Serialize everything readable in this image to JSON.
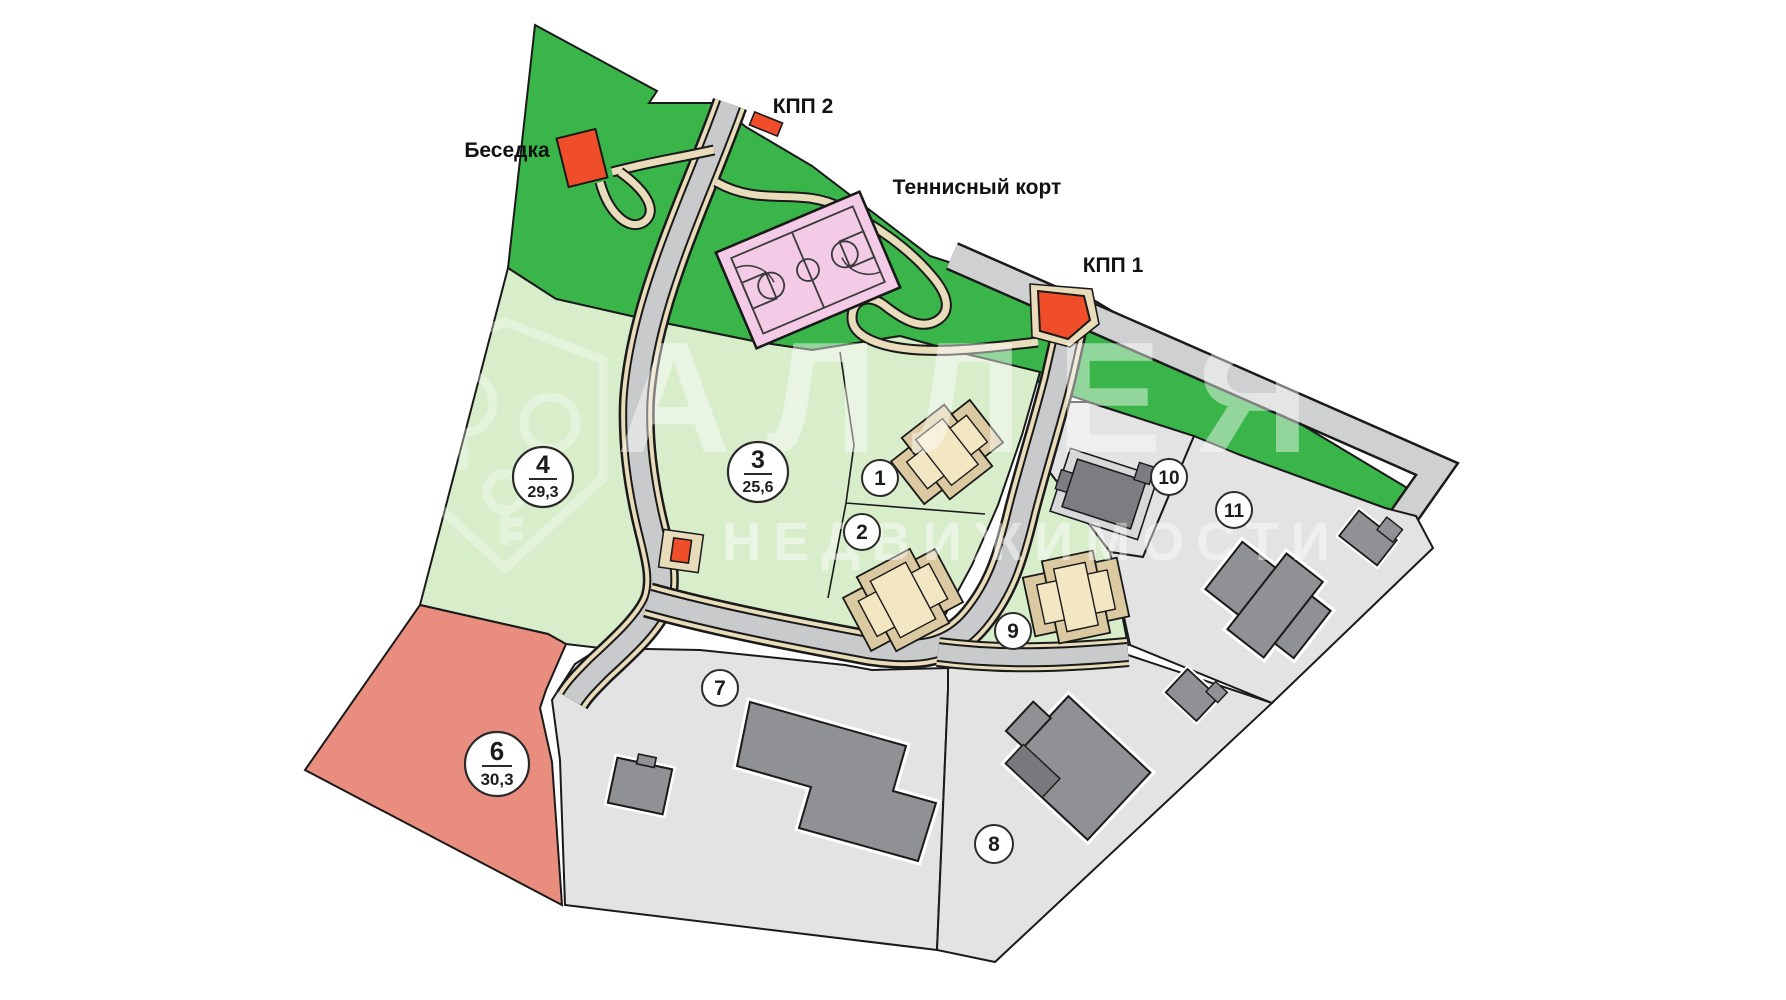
{
  "map": {
    "labels": {
      "gazebo": "Беседка",
      "checkpoint2": "КПП 2",
      "tennis_court": "Теннисный корт",
      "checkpoint1": "КПП 1"
    },
    "plots": {
      "p1": {
        "num": "1"
      },
      "p2": {
        "num": "2"
      },
      "p3": {
        "num": "3",
        "area": "25,6"
      },
      "p4": {
        "num": "4",
        "area": "29,3"
      },
      "p6": {
        "num": "6",
        "area": "30,3"
      },
      "p7": {
        "num": "7"
      },
      "p8": {
        "num": "8"
      },
      "p9": {
        "num": "9"
      },
      "p10": {
        "num": "10"
      },
      "p11": {
        "num": "11"
      }
    },
    "watermark": {
      "brand_line1": "АЛЛЕЯ",
      "brand_line2": "НЕДВИЖИМОСТИ"
    },
    "colors": {
      "forest_green": "#3ab54a",
      "plot_green": "#d8eecb",
      "plot_red": "#e98d7e",
      "plot_gray": "#e3e3e3",
      "road_gray": "#c9cacb",
      "path_beige": "#e8dcba",
      "marker_red": "#f04e2a",
      "house_cream": "#f3e7c3",
      "house_tan": "#dbc9a1",
      "house_gray": "#8f9194",
      "court_pink": "#f3cbe7"
    }
  }
}
